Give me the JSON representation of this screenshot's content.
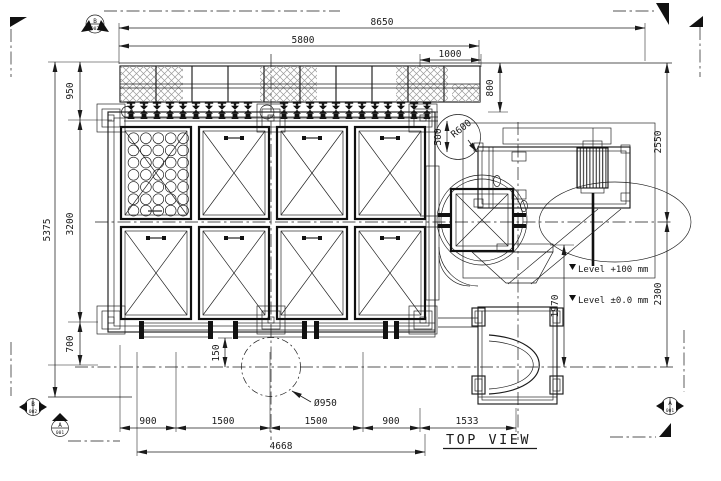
{
  "title": {
    "view_label": "TOP VIEW"
  },
  "dimensions": {
    "top_overall": "8650",
    "top_platform": "5800",
    "top_bay": "1000",
    "left_total": "5375",
    "left_top": "950",
    "left_mid": "3200",
    "left_bottom": "700",
    "right_upper": "2550",
    "right_lower": "2300",
    "right_walkway": "800",
    "right_gap": "500",
    "right_radius": "R600",
    "right_frame": "1970",
    "bottom_seg1": "900",
    "bottom_seg2": "1500",
    "bottom_seg3": "1500",
    "bottom_seg4": "900",
    "bottom_seg5": "1533",
    "bottom_total": "4668",
    "bottom_offset": "150",
    "pipe_diameter": "Ø950"
  },
  "levels": {
    "upper": "Level +100 mm",
    "lower": "Level ±0.0 mm"
  },
  "section_markers": {
    "top_left": {
      "letter": "B",
      "number": "002"
    },
    "bottom_left_outer": {
      "letter": "B",
      "number": "002"
    },
    "bottom_left_inner": {
      "letter": "A",
      "number": "001"
    },
    "right": {
      "letter": "A",
      "number": "001"
    }
  },
  "colors": {
    "line": "#1b1b1b",
    "hatch": "#9a9a9a",
    "background": "#ffffff"
  }
}
